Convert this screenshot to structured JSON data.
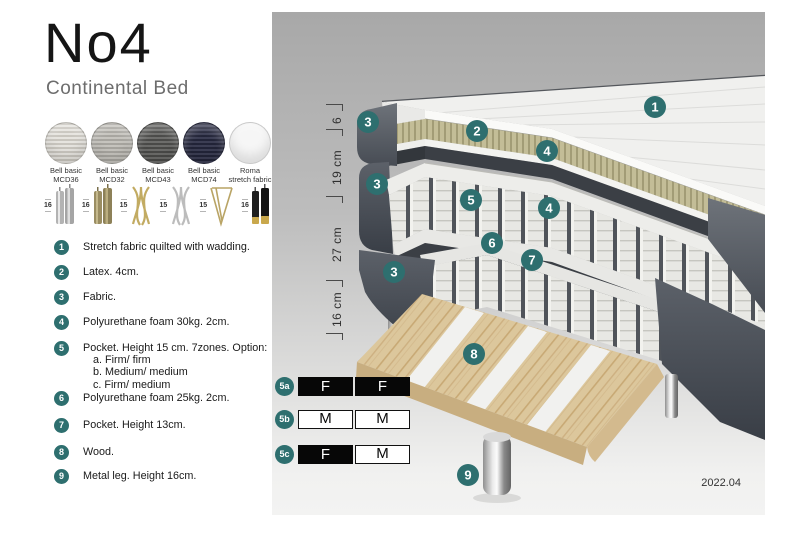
{
  "title": "No4",
  "subtitle": "Continental Bed",
  "swatches": [
    {
      "line1": "Bell basic",
      "line2": "MCD36"
    },
    {
      "line1": "Bell basic",
      "line2": "MCD32"
    },
    {
      "line1": "Bell basic",
      "line2": "MCD43"
    },
    {
      "line1": "Bell basic",
      "line2": "MCD74"
    },
    {
      "line1": "Roma",
      "line2": "stretch fabric"
    }
  ],
  "leg_options": [
    {
      "height": "16"
    },
    {
      "height": "16"
    },
    {
      "height": "15"
    },
    {
      "height": "15"
    },
    {
      "height": "15"
    },
    {
      "height": "16"
    }
  ],
  "features": [
    {
      "num": "1",
      "text": "Stretch fabric quilted with wadding."
    },
    {
      "num": "2",
      "text": "Latex. 4cm."
    },
    {
      "num": "3",
      "text": "Fabric."
    },
    {
      "num": "4",
      "text": "Polyurethane foam 30kg. 2cm."
    },
    {
      "num": "5",
      "text": "Pocket. Height 15 cm. 7zones. Option:",
      "options": [
        "a. Firm/ firm",
        "b. Medium/ medium",
        "c. Firm/ medium"
      ]
    },
    {
      "num": "6",
      "text": "Polyurethane foam 25kg. 2cm."
    },
    {
      "num": "7",
      "text": "Pocket. Height 13cm."
    },
    {
      "num": "8",
      "text": "Wood."
    },
    {
      "num": "9",
      "text": "Metal leg. Height 16cm."
    }
  ],
  "diagram": {
    "dimensions": [
      {
        "label": "6"
      },
      {
        "label": "19 cm"
      },
      {
        "label": "27 cm"
      },
      {
        "label": "16 cm"
      }
    ],
    "callouts": {
      "c1": "1",
      "c2": "2",
      "c3": "3",
      "c4": "4",
      "c5": "5",
      "c6": "6",
      "c7": "7",
      "c8": "8",
      "c9": "9"
    },
    "firmness": [
      {
        "label": "5a",
        "cells": [
          {
            "value": "F",
            "style": "dark"
          },
          {
            "value": "F",
            "style": "dark"
          }
        ]
      },
      {
        "label": "5b",
        "cells": [
          {
            "value": "M",
            "style": "light"
          },
          {
            "value": "M",
            "style": "light"
          }
        ]
      },
      {
        "label": "5c",
        "cells": [
          {
            "value": "F",
            "style": "dark"
          },
          {
            "value": "M",
            "style": "light"
          }
        ]
      }
    ],
    "version": "2022.04"
  },
  "colors": {
    "accent_teal": "#2E6F6F",
    "fabric_gray": "#4B5058",
    "latex_khaki": "#BDB791",
    "wood": "#DCC79C",
    "panel_top": "#A8A8A8",
    "panel_bottom": "#F3F3F2"
  }
}
